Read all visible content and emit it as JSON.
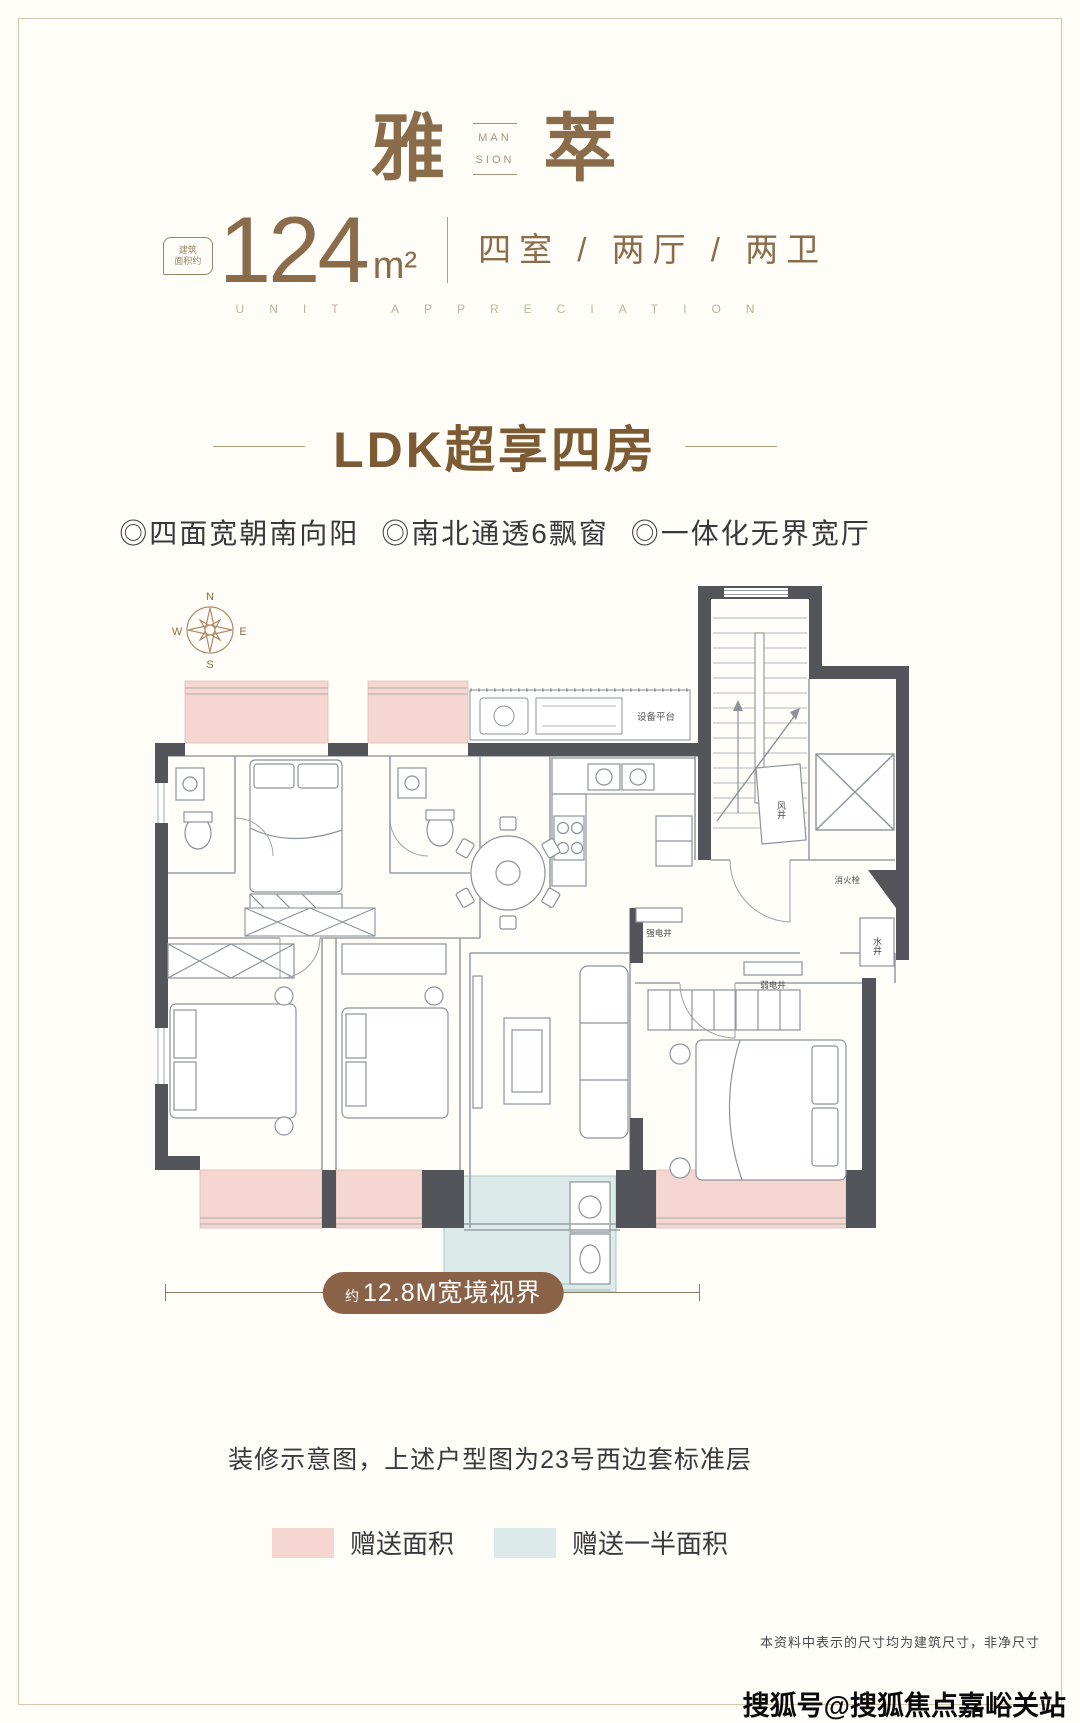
{
  "header": {
    "title_cn_left": "雅",
    "title_cn_right": "萃",
    "title_en_line1": "MAN",
    "title_en_line2": "SION",
    "area_badge_line1": "建筑",
    "area_badge_line2": "面积约",
    "area_value": "124",
    "area_unit": "m²",
    "layout_text": "四室 / 两厅 / 两卫",
    "tagline_en": "UNIT APPRECIATION"
  },
  "selling": {
    "heading": "LDK超享四房",
    "features": [
      "◎四面宽朝南向阳",
      "◎南北通透6飘窗",
      "◎一体化无界宽厅"
    ]
  },
  "floorplan": {
    "compass": {
      "north": "N",
      "south": "S",
      "east": "E",
      "west": "W"
    },
    "labels": {
      "equipment_platform": "设备平台",
      "air_shaft": "风井",
      "fire_hydrant": "消火栓",
      "water_shaft": "水井",
      "strong_electric_shaft": "强电井",
      "weak_electric_shaft": "弱电井"
    },
    "dimension": {
      "prefix": "约",
      "value": "12.8M",
      "suffix": "宽境视界"
    }
  },
  "footer": {
    "caption": "装修示意图，上述户型图为23号西边套标准层",
    "legend": [
      {
        "label": "赠送面积",
        "color": "#f5d6d0"
      },
      {
        "label": "赠送一半面积",
        "color": "#dcebe9"
      }
    ],
    "disclaimer": "本资料中表示的尺寸均为建筑尺寸，非净尺寸",
    "watermark": "搜狐号@搜狐焦点嘉峪关站"
  },
  "colors": {
    "brand_brown": "#8a6c4a",
    "heading_brown": "#7c5a33",
    "pill_brown": "#8a6248",
    "wall_dark": "#54555a",
    "gift_pink": "#f5d6d0",
    "half_gift_blue": "#dcebe9",
    "frame_tan": "#d6c8ac"
  }
}
